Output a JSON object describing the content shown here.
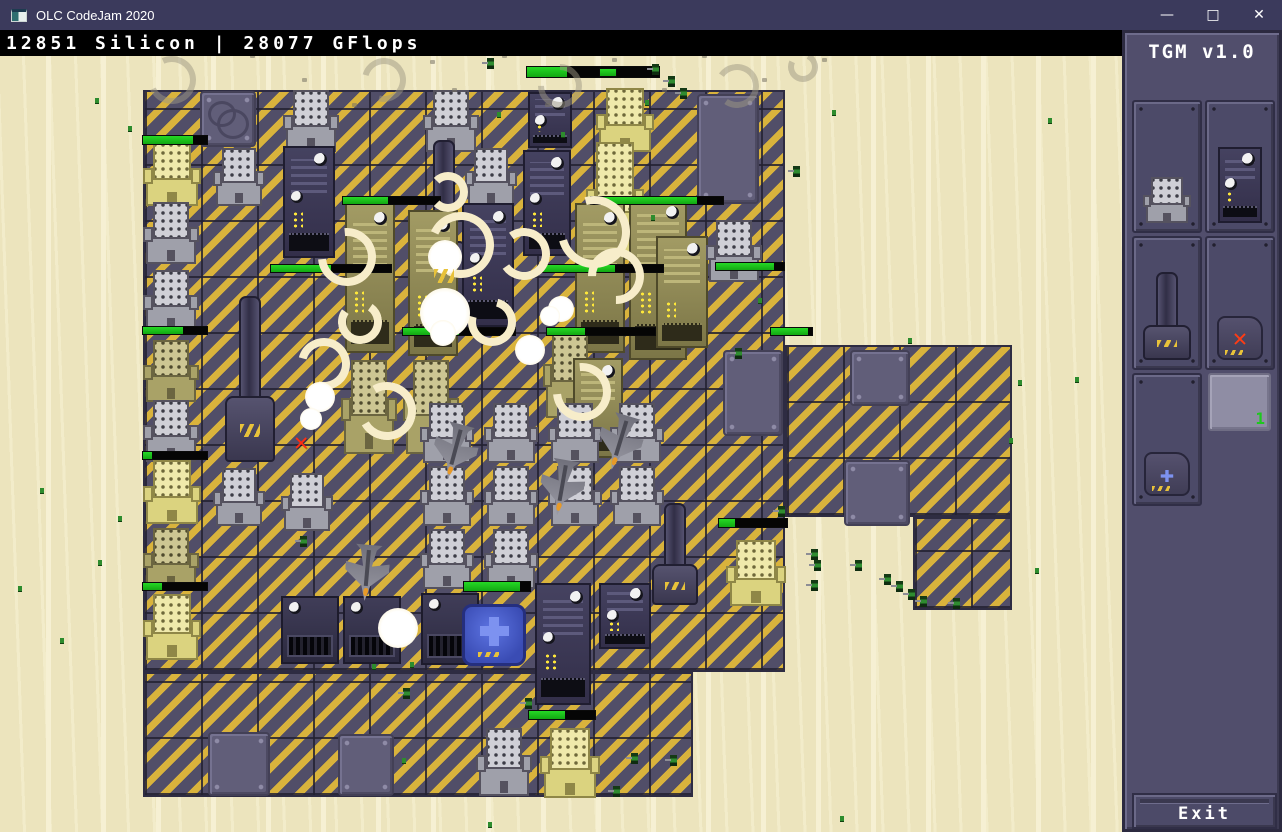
{
  "window": {
    "title": "OLC CodeJam 2020",
    "controls": {
      "minimize": "—",
      "maximize": "□",
      "close": "✕"
    }
  },
  "hud": {
    "resources": "12851 Silicon | 28077 GFlops"
  },
  "sidebar": {
    "title": "TGM v1.0",
    "exit_label": "Exit",
    "slots": [
      {
        "name": "factory-building"
      },
      {
        "name": "server-building"
      },
      {
        "name": "turret-building"
      },
      {
        "name": "demolish-tool",
        "glyph": "✕"
      },
      {
        "name": "repair-tool",
        "glyph": "✚"
      },
      {
        "name": "empty-slot",
        "count": "1"
      }
    ]
  },
  "colors": {
    "titlebar": "#3b3a5c",
    "statusbar": "#000000",
    "sand": "#ece4bd",
    "hazard_yellow": "#d9b33c",
    "floor_dark": "#514e68",
    "health_green": "#1dc91d",
    "sidebar_bg": "#514e6c",
    "repair_blue": "#4a5fd0",
    "alert_red": "#ff2d12",
    "count_green": "#1ec81e",
    "smoke_cream": "#f7edca"
  },
  "scene": {
    "floors_format": "x,y,w,h",
    "floors": [
      [
        143,
        90,
        642,
        582
      ],
      [
        143,
        672,
        550,
        125
      ],
      [
        785,
        345,
        227,
        172
      ],
      [
        913,
        517,
        99,
        93
      ]
    ],
    "plates_format": "x,y,w,h,style",
    "plates": [
      [
        200,
        91,
        56,
        56,
        "craters"
      ],
      [
        697,
        94,
        62,
        110,
        ""
      ],
      [
        723,
        350,
        60,
        86,
        ""
      ],
      [
        850,
        350,
        60,
        56,
        ""
      ],
      [
        844,
        460,
        66,
        66,
        ""
      ],
      [
        208,
        732,
        62,
        64,
        ""
      ],
      [
        338,
        734,
        56,
        62,
        ""
      ]
    ],
    "buildings_format": "type,x,y,w,h",
    "buildings": [
      [
        "fg",
        283,
        90,
        56,
        62
      ],
      [
        "fg",
        423,
        90,
        56,
        62
      ],
      [
        "sv",
        528,
        92,
        44,
        56
      ],
      [
        "fy",
        596,
        88,
        58,
        64
      ],
      [
        "fy",
        143,
        142,
        58,
        64
      ],
      [
        "fg",
        213,
        148,
        52,
        58
      ],
      [
        "sv",
        283,
        146,
        52,
        112
      ],
      [
        "tw",
        420,
        140,
        48,
        168
      ],
      [
        "fg",
        465,
        148,
        52,
        58
      ],
      [
        "sv",
        523,
        150,
        48,
        106
      ],
      [
        "fy",
        586,
        142,
        58,
        118
      ],
      [
        "fg",
        143,
        202,
        56,
        62
      ],
      [
        "fg",
        143,
        270,
        56,
        62
      ],
      [
        "so",
        345,
        203,
        50,
        150
      ],
      [
        "so",
        408,
        210,
        50,
        146
      ],
      [
        "sv",
        462,
        203,
        52,
        124
      ],
      [
        "so",
        575,
        203,
        50,
        150
      ],
      [
        "so",
        629,
        196,
        58,
        164
      ],
      [
        "so",
        656,
        236,
        52,
        112
      ],
      [
        "fg",
        706,
        220,
        56,
        62
      ],
      [
        "tw",
        224,
        296,
        52,
        166
      ],
      [
        "fo",
        143,
        340,
        56,
        62
      ],
      [
        "fo",
        341,
        360,
        56,
        94
      ],
      [
        "fo",
        403,
        360,
        56,
        94
      ],
      [
        "fo",
        543,
        328,
        54,
        90
      ],
      [
        "so",
        573,
        358,
        50,
        100
      ],
      [
        "fg",
        143,
        400,
        56,
        62
      ],
      [
        "fy",
        143,
        460,
        58,
        64
      ],
      [
        "fo",
        143,
        528,
        56,
        62
      ],
      [
        "fy",
        143,
        594,
        58,
        66
      ],
      [
        "fg",
        420,
        403,
        54,
        60
      ],
      [
        "fg",
        484,
        403,
        54,
        60
      ],
      [
        "fg",
        548,
        403,
        54,
        60
      ],
      [
        "fg",
        610,
        403,
        54,
        60
      ],
      [
        "fg",
        213,
        468,
        52,
        58
      ],
      [
        "fg",
        281,
        473,
        52,
        58
      ],
      [
        "fg",
        420,
        466,
        54,
        60
      ],
      [
        "fg",
        484,
        466,
        54,
        60
      ],
      [
        "fg",
        548,
        466,
        54,
        60
      ],
      [
        "fg",
        610,
        466,
        54,
        60
      ],
      [
        "fg",
        420,
        529,
        54,
        60
      ],
      [
        "fg",
        484,
        529,
        54,
        60
      ],
      [
        "gw",
        281,
        596,
        58,
        68
      ],
      [
        "gw",
        343,
        596,
        58,
        68
      ],
      [
        "gw",
        421,
        593,
        58,
        72
      ],
      [
        "sv",
        535,
        583,
        56,
        122
      ],
      [
        "sv",
        599,
        583,
        52,
        66
      ],
      [
        "tw",
        651,
        503,
        48,
        102
      ],
      [
        "fy",
        726,
        540,
        60,
        66
      ],
      [
        "rp",
        462,
        604,
        64,
        62
      ],
      [
        "fg",
        476,
        728,
        56,
        68
      ],
      [
        "fy",
        540,
        728,
        60,
        70
      ]
    ],
    "healthbars_format": "x,y,w,h,fill",
    "healthbars": [
      [
        143,
        136,
        64,
        8,
        0.78
      ],
      [
        527,
        67,
        132,
        10,
        0.3
      ],
      [
        600,
        69,
        16,
        7,
        1.0
      ],
      [
        343,
        197,
        97,
        7,
        0.46
      ],
      [
        591,
        197,
        132,
        7,
        0.8
      ],
      [
        271,
        265,
        120,
        7,
        0.5
      ],
      [
        543,
        265,
        120,
        7,
        0.6
      ],
      [
        716,
        263,
        68,
        7,
        0.85
      ],
      [
        403,
        328,
        112,
        7,
        0.5
      ],
      [
        547,
        328,
        108,
        7,
        0.35
      ],
      [
        771,
        328,
        41,
        7,
        0.9
      ],
      [
        143,
        327,
        64,
        7,
        0.62
      ],
      [
        143,
        452,
        64,
        7,
        0.14
      ],
      [
        143,
        583,
        64,
        7,
        0.3
      ],
      [
        464,
        582,
        66,
        9,
        0.85
      ],
      [
        719,
        519,
        68,
        8,
        0.23
      ],
      [
        529,
        711,
        66,
        8,
        0.55
      ]
    ],
    "smoke_rings_format": "x,y,size,rotation",
    "smoke_rings": [
      [
        318,
        228,
        58,
        40
      ],
      [
        428,
        212,
        66,
        -20
      ],
      [
        498,
        228,
        52,
        10
      ],
      [
        558,
        196,
        72,
        30
      ],
      [
        298,
        338,
        52,
        -30
      ],
      [
        358,
        382,
        58,
        15
      ],
      [
        553,
        363,
        58,
        40
      ],
      [
        428,
        172,
        40,
        0
      ],
      [
        468,
        298,
        48,
        60
      ],
      [
        588,
        248,
        56,
        -45
      ],
      [
        338,
        300,
        44,
        80
      ]
    ],
    "gray_rings": [
      [
        148,
        56,
        48,
        20
      ],
      [
        362,
        58,
        44,
        -30
      ],
      [
        538,
        64,
        44,
        45
      ],
      [
        715,
        64,
        44,
        -10
      ],
      [
        788,
        52,
        30,
        70
      ]
    ],
    "puffs_format": "x,y,size",
    "puffs": [
      [
        420,
        288,
        50
      ],
      [
        515,
        335,
        30
      ],
      [
        548,
        296,
        26
      ],
      [
        378,
        608,
        40
      ],
      [
        305,
        382,
        30
      ],
      [
        428,
        240,
        34
      ],
      [
        540,
        306,
        20
      ],
      [
        300,
        408,
        22
      ],
      [
        430,
        320,
        26
      ]
    ],
    "jets_format": "x,y,rotation",
    "jets": [
      [
        433,
        422,
        195
      ],
      [
        540,
        458,
        190
      ],
      [
        598,
        413,
        197
      ],
      [
        345,
        543,
        185
      ]
    ],
    "soldiers": [
      [
        487,
        58
      ],
      [
        652,
        64
      ],
      [
        668,
        76
      ],
      [
        680,
        88
      ],
      [
        793,
        166
      ],
      [
        735,
        348
      ],
      [
        778,
        506
      ],
      [
        300,
        536
      ],
      [
        811,
        549
      ],
      [
        814,
        560
      ],
      [
        855,
        560
      ],
      [
        811,
        580
      ],
      [
        884,
        574
      ],
      [
        896,
        581
      ],
      [
        908,
        589
      ],
      [
        920,
        596
      ],
      [
        953,
        598
      ],
      [
        631,
        753
      ],
      [
        670,
        755
      ],
      [
        613,
        786
      ],
      [
        525,
        698
      ],
      [
        403,
        688
      ]
    ],
    "green_debris": [
      [
        95,
        98
      ],
      [
        128,
        126
      ],
      [
        498,
        46
      ],
      [
        645,
        100
      ],
      [
        832,
        110
      ],
      [
        1048,
        118
      ],
      [
        908,
        338
      ],
      [
        1018,
        380
      ],
      [
        1075,
        377
      ],
      [
        1009,
        438
      ],
      [
        40,
        488
      ],
      [
        118,
        516
      ],
      [
        98,
        560
      ],
      [
        18,
        586
      ],
      [
        60,
        638
      ],
      [
        410,
        662
      ],
      [
        372,
        664
      ],
      [
        402,
        758
      ],
      [
        488,
        822
      ],
      [
        840,
        816
      ],
      [
        1035,
        568
      ],
      [
        758,
        298
      ],
      [
        651,
        215
      ],
      [
        497,
        112
      ],
      [
        561,
        132
      ]
    ],
    "gray_debris": [
      [
        250,
        54
      ],
      [
        302,
        78
      ],
      [
        452,
        88
      ],
      [
        502,
        54
      ],
      [
        612,
        58
      ],
      [
        662,
        88
      ],
      [
        702,
        54
      ],
      [
        762,
        78
      ],
      [
        822,
        58
      ],
      [
        545,
        103
      ],
      [
        352,
        103
      ],
      [
        390,
        45
      ],
      [
        430,
        60
      ]
    ],
    "markers_format": "x,y,glyph",
    "markers": [
      [
        294,
        430,
        "✕"
      ]
    ]
  }
}
